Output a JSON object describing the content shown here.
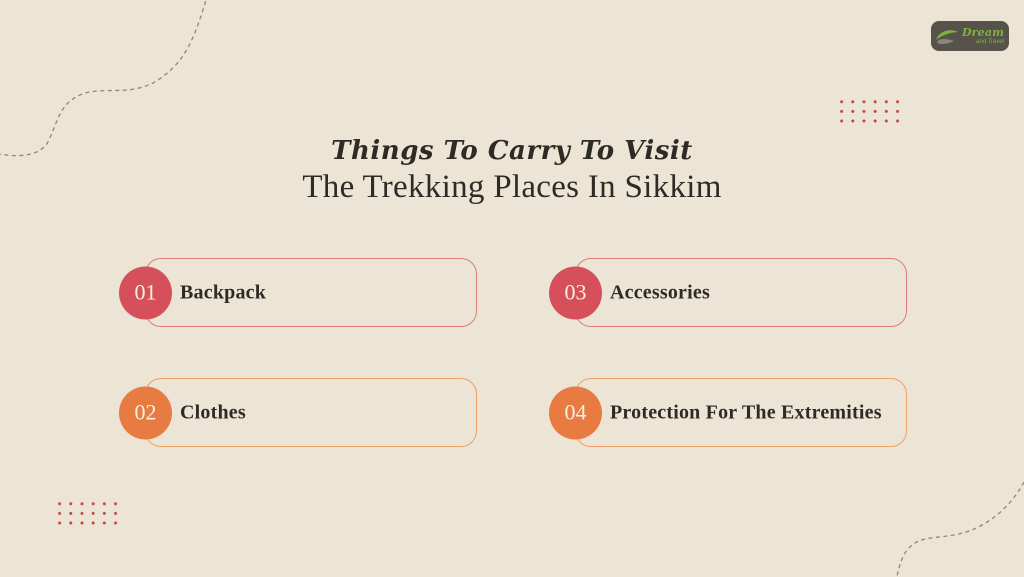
{
  "title": {
    "line1": "Things To Carry To Visit",
    "line2": "The Trekking Places In Sikkim"
  },
  "logo": {
    "name": "Dream",
    "tagline": "and Travel",
    "icon": "leaf-swoosh-icon"
  },
  "items": [
    {
      "number": "01",
      "label": "Backpack",
      "accent": "red"
    },
    {
      "number": "02",
      "label": "Clothes",
      "accent": "orange"
    },
    {
      "number": "03",
      "label": "Accessories",
      "accent": "red"
    },
    {
      "number": "04",
      "label": "Protection For The Extremities",
      "accent": "orange"
    }
  ],
  "decor": {
    "top_left": "dashed-wave-line",
    "bottom_right": "dashed-wave-line",
    "top_right": "dot-grid",
    "bottom_left": "dot-grid"
  },
  "colors": {
    "background": "#ece4d4",
    "red_circle": "#d5505a",
    "red_border": "#dd7d78",
    "orange_circle": "#e87b42",
    "orange_border": "#eba266",
    "heading_text": "#2e2a26",
    "number_text": "#f7f0e1",
    "dot": "#c2453e",
    "dash_line": "#8d8679",
    "logo_background": "#57534a",
    "logo_green": "#7cb342"
  }
}
